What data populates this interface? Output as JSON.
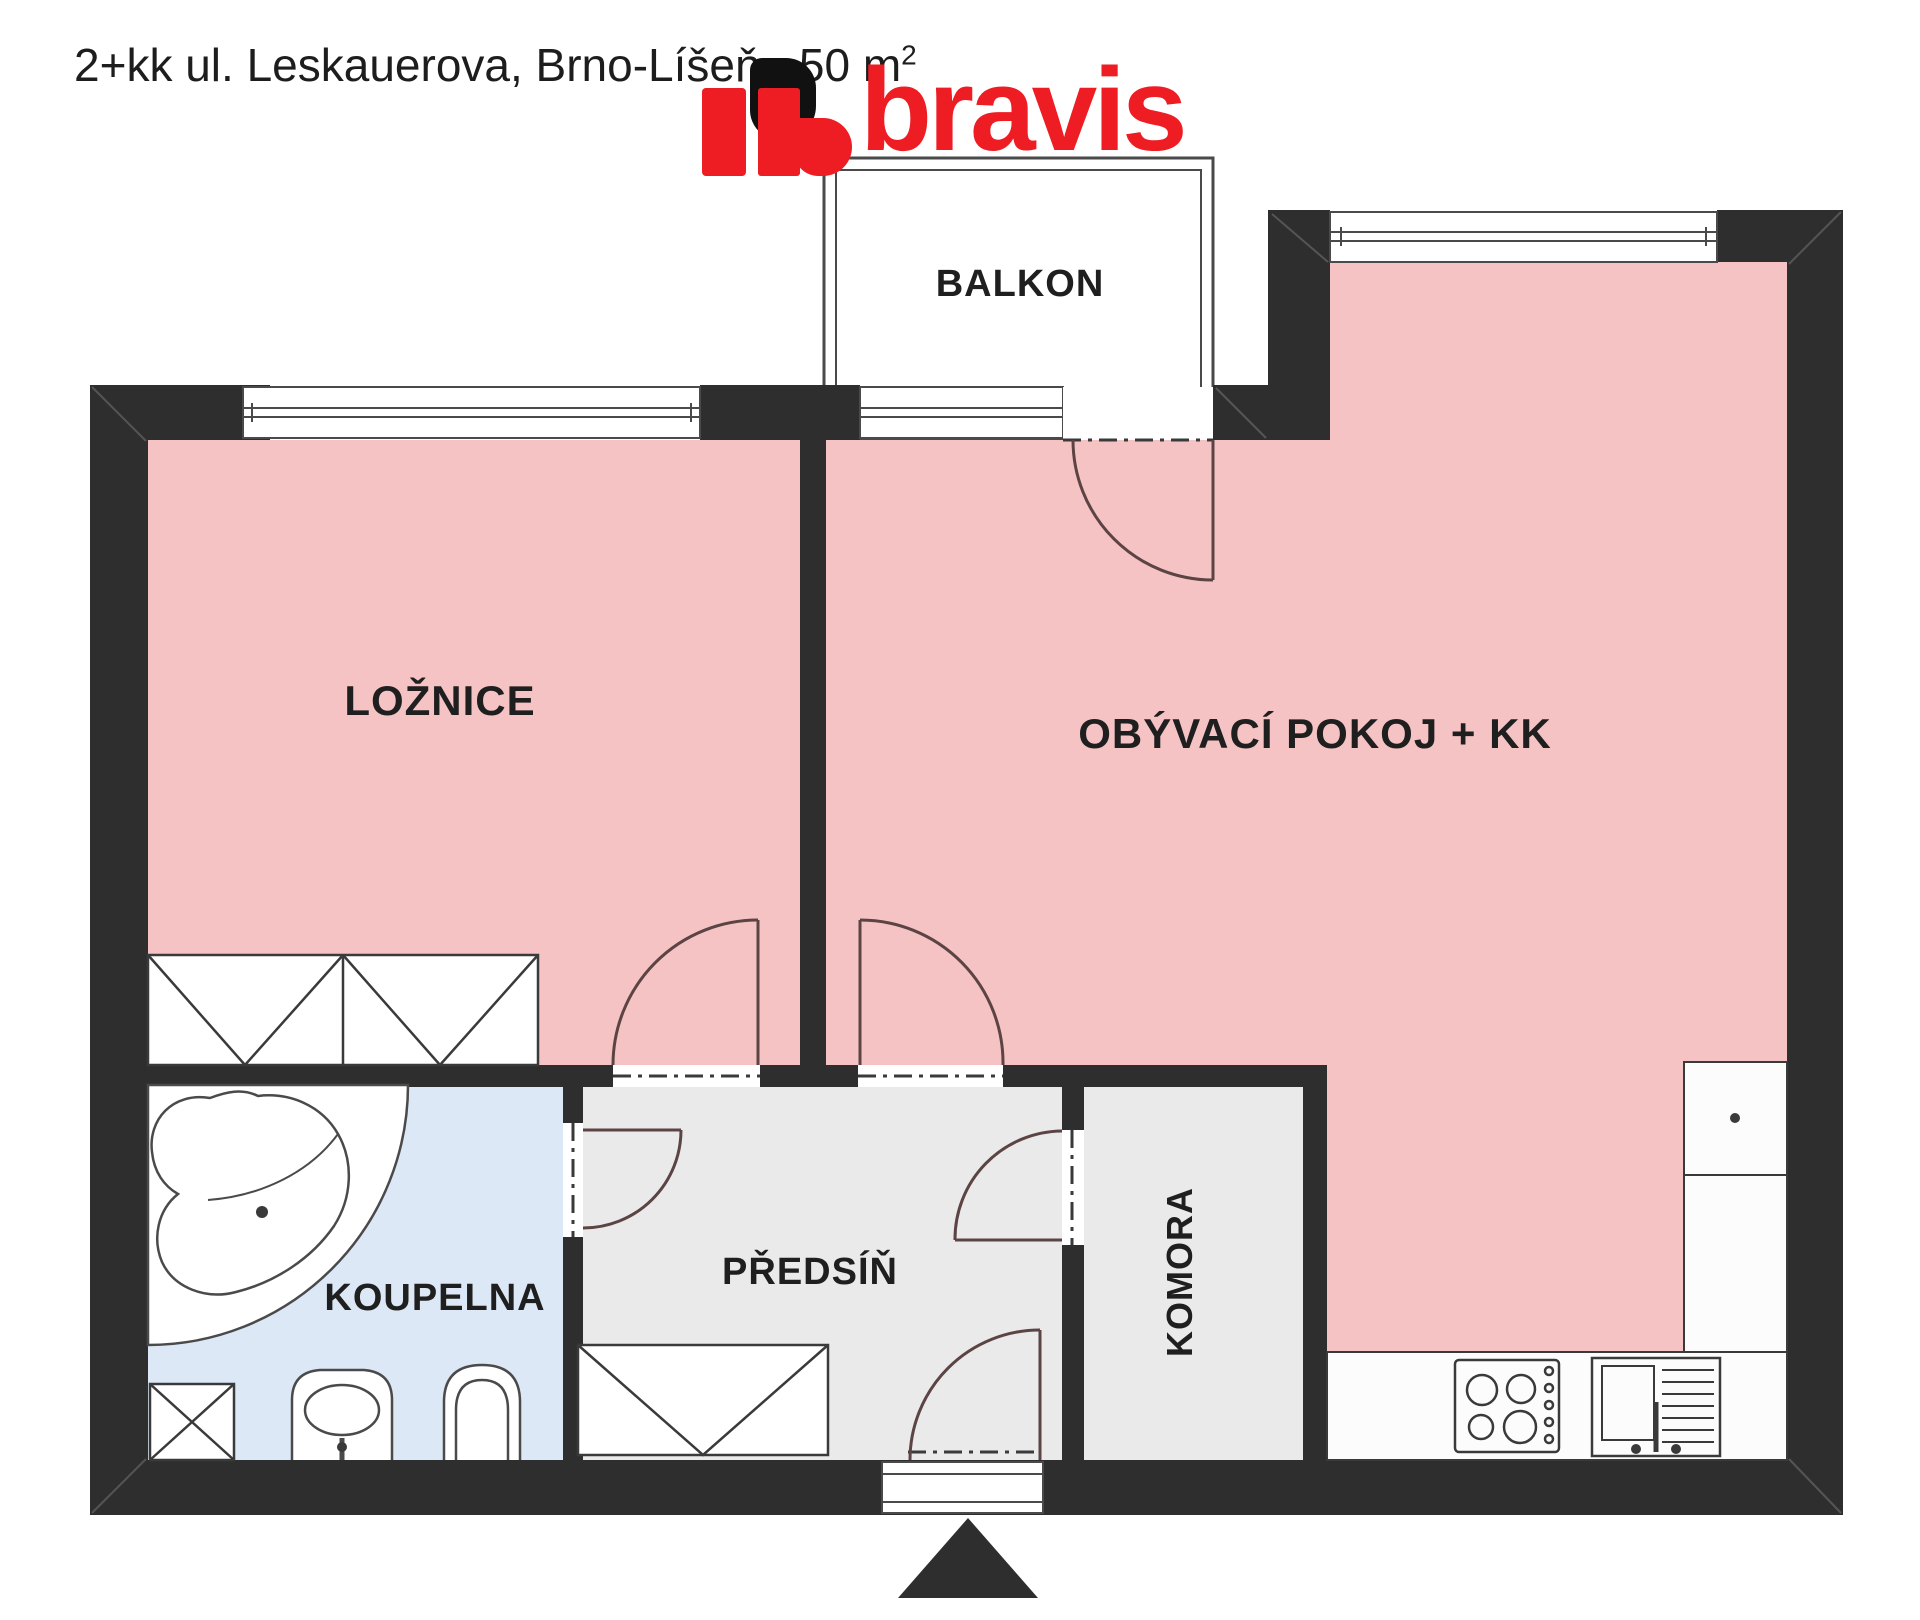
{
  "header": {
    "title_text": "2+kk ul. Leskauerova, Brno-Líšeň , 50 m",
    "title_superscript": "2",
    "logo_text": "bravis"
  },
  "floorplan": {
    "rooms": {
      "bedroom": "LOŽNICE",
      "living_room": "OBÝVACÍ POKOJ + KK",
      "balcony": "BALKON",
      "bathroom": "KOUPELNA",
      "hallway": "PŘEDSÍŇ",
      "storage": "KOMORA"
    },
    "colors": {
      "wall": "#2e2e2e",
      "room_pink": "#f6c3c4",
      "room_gray": "#eaeaea",
      "room_blue": "#dde8f6",
      "fixture_line": "#4a4a4a",
      "door_arc": "#5c4444",
      "logo_red": "#ee1c23"
    }
  }
}
